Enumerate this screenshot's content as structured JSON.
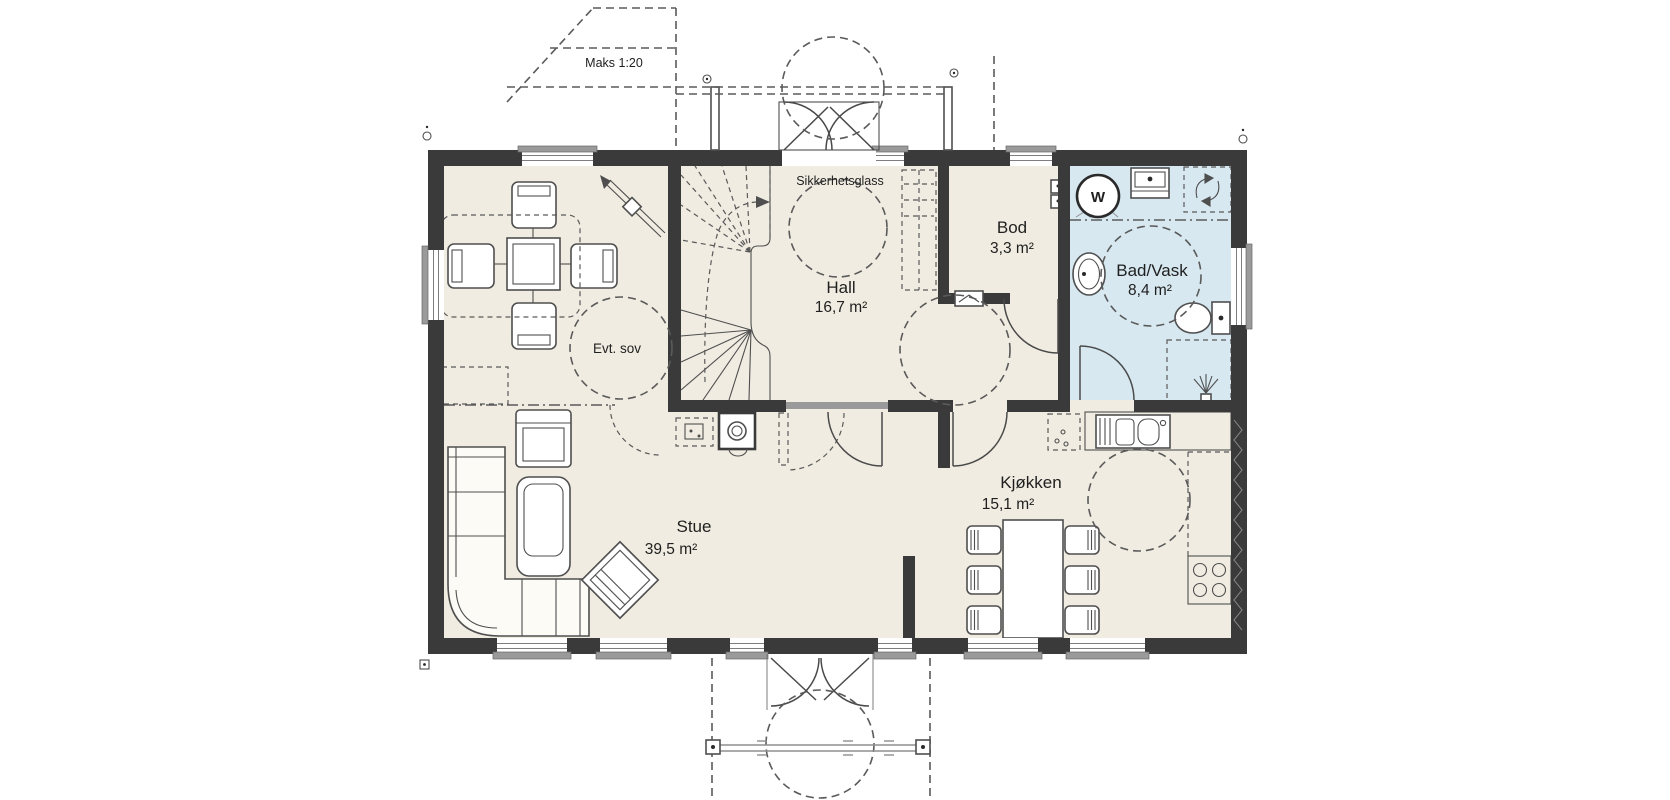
{
  "rooms": {
    "hall": {
      "name": "Hall",
      "area": "16,7 m²"
    },
    "bod": {
      "name": "Bod",
      "area": "3,3 m²"
    },
    "bad_vask": {
      "name": "Bad/Vask",
      "area": "8,4 m²"
    },
    "evt_sov": {
      "name": "Evt. sov"
    },
    "stue": {
      "name": "Stue",
      "area": "39,5 m²"
    },
    "kjokken": {
      "name": "Kjøkken",
      "area": "15,1 m²"
    }
  },
  "annotations": {
    "ramp": "Maks 1:20",
    "safety_glass": "Sikkerhetsglass",
    "washing_machine": "W"
  },
  "colors": {
    "wall": "#3a3a3a",
    "floor": "#f0ece1",
    "bathroom_floor": "#d7e8f1",
    "line": "#4f4f4f",
    "dash": "#5a5a5a",
    "window": "#9a9a9a",
    "background": "#ffffff"
  }
}
